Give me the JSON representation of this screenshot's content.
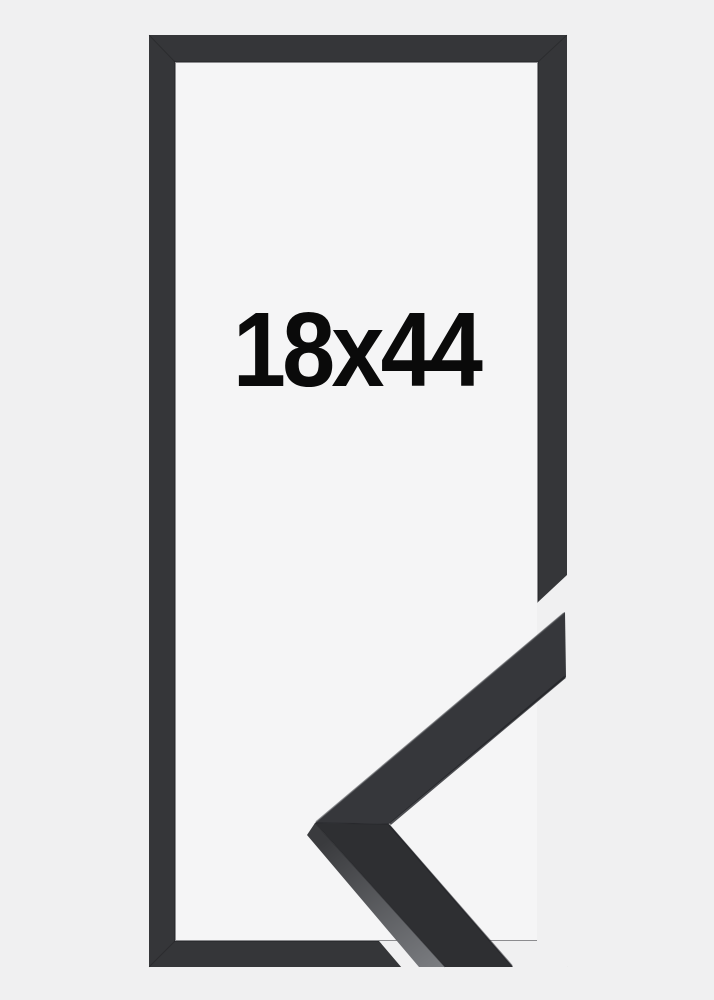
{
  "product_image": {
    "size_label": "18x44",
    "colors": {
      "page_background": "#f0f0f1",
      "frame_opening": "#f5f5f6",
      "frame_fill": "#353639",
      "frame_inner_shadow": "#232427",
      "label_text": "#0a0a0a",
      "sample_top_face": "#36373b",
      "sample_bottom_face": "#2e2f32",
      "sample_side_dark": "#3a3b3e",
      "sample_side_light": "#7b7d81",
      "sample_edge_highlight": "#55575b",
      "sample_edge_shadow": "#232428"
    }
  }
}
